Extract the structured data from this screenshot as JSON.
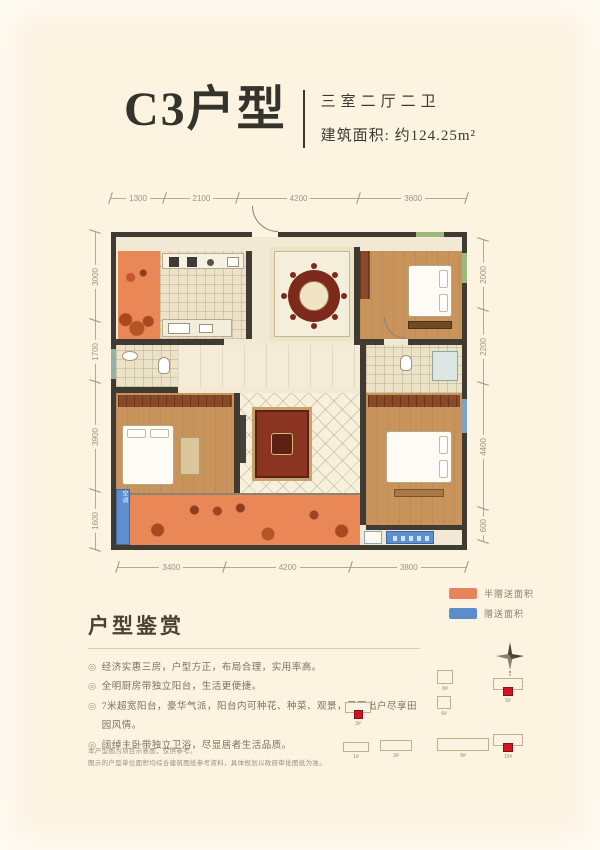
{
  "header": {
    "title": "C3户型",
    "rooms": "三室二厅二卫",
    "area": "建筑面积: 约124.25m²"
  },
  "dims": {
    "top": [
      "1300",
      "2100",
      "4200",
      "3600"
    ],
    "left": [
      "3000",
      "1700",
      "3900",
      "1600"
    ],
    "right": [
      "2000",
      "2200",
      "4400",
      "600"
    ],
    "bottom": [
      "3400",
      "4200",
      "3800"
    ]
  },
  "plan": {
    "ac_label": "空调"
  },
  "legend": {
    "items": [
      {
        "label": "半赠送面积",
        "color": "#e8845c"
      },
      {
        "label": "赠送面积",
        "color": "#5b8ccc"
      }
    ]
  },
  "appreciation": {
    "heading": "户型鉴赏",
    "bullet_char": "◎",
    "bullets": [
      "经济实惠三房，户型方正，布局合理，实用率高。",
      "全明厨房带独立阳台，生活更便捷。",
      "7米超宽阳台，豪华气派，阳台内可种花、种菜、观景，足不出户尽享田园风情。",
      "阔绰主卧带独立卫浴，尽显居者生活品质。"
    ]
  },
  "disclaimer": {
    "line1": "本户型图为项目示意图，仅供参考。",
    "line2": "图示的户型单位面积均综合建筑图纸参考资料，具体规划以政府审批图纸为准。"
  },
  "siteplan": {
    "highlight_color": "#cf1422",
    "buildings": [
      {
        "label": "8#"
      },
      {
        "label": "6#"
      },
      {
        "label": "5#"
      },
      {
        "label": "3#"
      },
      {
        "label": "1#"
      },
      {
        "label": "2#"
      },
      {
        "label": "9#"
      },
      {
        "label": "10#"
      }
    ]
  }
}
